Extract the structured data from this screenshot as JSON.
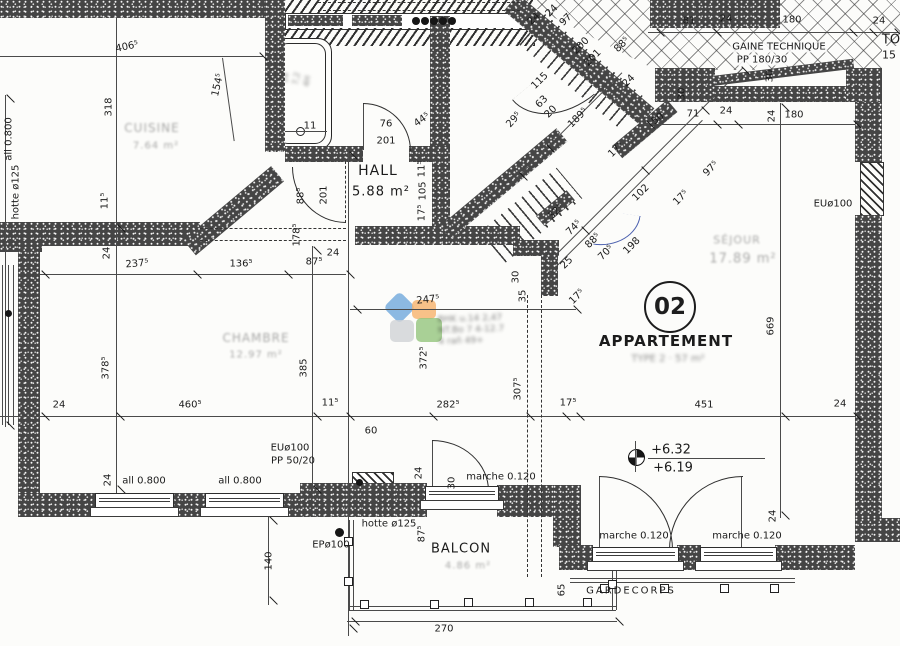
{
  "plan": {
    "apartment": {
      "number": "02",
      "title": "APPARTEMENT",
      "subtitle_faint": "TYPE 2 · 57 m²"
    },
    "rooms": [
      {
        "name": "HALL",
        "area": "5.88 m²"
      },
      {
        "name": "BALCON",
        "area_faint": "4.86 m²"
      },
      {
        "name": "SÉJOUR",
        "area_faint": "17.89 m²",
        "legibility": "faint"
      },
      {
        "name": "CHAMBRE",
        "area_faint": "12.97 m²",
        "legibility": "faint"
      },
      {
        "name": "CUISINE",
        "area_faint": "7.64 m²",
        "legibility": "faint"
      }
    ],
    "annotations": {
      "duct": "GAINE TECHNIQUE",
      "duct_detail": "PP 180/30",
      "guardrail": "GARDECORPS",
      "levels": [
        "+6.32",
        "+6.19"
      ],
      "step_label": "marche 0.120",
      "hood": "hotte ø125",
      "drain_eu": "EUø100",
      "drain_ep": "EPø100",
      "sill_height": "all 0.800",
      "pipe": "PP 50/20",
      "balcony_width": "270",
      "edge_fragments": [
        "TO",
        "15"
      ]
    },
    "colors": {
      "wall": "#454545",
      "line": "#2e2e2e",
      "pen_annotation_blue": "#4a5fae",
      "watermark_blue": "#6fa8dc",
      "watermark_orange": "#f6b26b",
      "watermark_green": "#93c47d",
      "watermark_gray": "#cfd2d6"
    },
    "texts": [
      {
        "t": "406⁵",
        "x": 127,
        "y": 47,
        "r": -12,
        "cls": "dim"
      },
      {
        "t": "318",
        "x": 109,
        "y": 107,
        "r": -90,
        "cls": "dim"
      },
      {
        "t": "154⁵",
        "x": 218,
        "y": 85,
        "r": -77,
        "cls": "dim"
      },
      {
        "t": "all 0.800",
        "x": 9,
        "y": 139,
        "r": -90,
        "cls": "lbl"
      },
      {
        "t": "hotte ø125",
        "x": 16,
        "y": 192,
        "r": -90,
        "cls": "lbl"
      },
      {
        "t": "11⁵",
        "x": 105,
        "y": 201,
        "r": -90,
        "cls": "dim"
      },
      {
        "t": "11",
        "x": 310,
        "y": 126,
        "r": 0,
        "cls": "dim"
      },
      {
        "t": "76",
        "x": 386,
        "y": 124,
        "r": 0,
        "cls": "dim"
      },
      {
        "t": "201",
        "x": 386,
        "y": 141,
        "r": 0,
        "cls": "dim"
      },
      {
        "t": "44⁵",
        "x": 422,
        "y": 120,
        "r": -35,
        "cls": "dim"
      },
      {
        "t": "29⁵",
        "x": 514,
        "y": 120,
        "r": -48,
        "cls": "dim"
      },
      {
        "t": "88⁵",
        "x": 301,
        "y": 196,
        "r": -90,
        "cls": "dim"
      },
      {
        "t": "201",
        "x": 324,
        "y": 195,
        "r": -90,
        "cls": "dim"
      },
      {
        "t": "HALL",
        "x": 378,
        "y": 171,
        "r": 0,
        "cls": "room"
      },
      {
        "t": "5.88 m²",
        "x": 381,
        "y": 192,
        "r": 0,
        "cls": "room",
        "fs": 13
      },
      {
        "t": "11⁵",
        "x": 422,
        "y": 169,
        "r": -90,
        "cls": "dim"
      },
      {
        "t": "105",
        "x": 423,
        "y": 191,
        "r": -90,
        "cls": "dim"
      },
      {
        "t": "17⁵",
        "x": 422,
        "y": 213,
        "r": -90,
        "cls": "dim"
      },
      {
        "t": "178⁵",
        "x": 297,
        "y": 235,
        "r": -90,
        "cls": "dim"
      },
      {
        "t": "24",
        "x": 107,
        "y": 253,
        "r": -90,
        "cls": "dim"
      },
      {
        "t": "24",
        "x": 333,
        "y": 253,
        "r": 0,
        "cls": "dim"
      },
      {
        "t": "237⁵",
        "x": 137,
        "y": 264,
        "r": -5,
        "cls": "dim"
      },
      {
        "t": "136⁵",
        "x": 241,
        "y": 264,
        "r": 0,
        "cls": "dim"
      },
      {
        "t": "87⁵",
        "x": 314,
        "y": 262,
        "r": 0,
        "cls": "dim"
      },
      {
        "t": "378⁵",
        "x": 106,
        "y": 368,
        "r": -90,
        "cls": "dim"
      },
      {
        "t": "385",
        "x": 304,
        "y": 368,
        "r": -90,
        "cls": "dim"
      },
      {
        "t": "24",
        "x": 59,
        "y": 405,
        "r": 0,
        "cls": "dim"
      },
      {
        "t": "460⁵",
        "x": 190,
        "y": 405,
        "r": 0,
        "cls": "dim"
      },
      {
        "t": "11⁵",
        "x": 330,
        "y": 403,
        "r": 0,
        "cls": "dim"
      },
      {
        "t": "282⁵",
        "x": 448,
        "y": 405,
        "r": 0,
        "cls": "dim"
      },
      {
        "t": "17⁵",
        "x": 568,
        "y": 403,
        "r": 0,
        "cls": "dim"
      },
      {
        "t": "451",
        "x": 704,
        "y": 405,
        "r": 0,
        "cls": "dim"
      },
      {
        "t": "24",
        "x": 840,
        "y": 404,
        "r": 0,
        "cls": "dim"
      },
      {
        "t": "247⁵",
        "x": 428,
        "y": 300,
        "r": -6,
        "cls": "dim"
      },
      {
        "t": "372⁵",
        "x": 424,
        "y": 358,
        "r": -90,
        "cls": "dim"
      },
      {
        "t": "30",
        "x": 516,
        "y": 277,
        "r": -90,
        "cls": "dim"
      },
      {
        "t": "35",
        "x": 523,
        "y": 296,
        "r": -90,
        "cls": "dim"
      },
      {
        "t": "307⁵",
        "x": 518,
        "y": 389,
        "r": -90,
        "cls": "dim"
      },
      {
        "t": "81",
        "x": 689,
        "y": 21,
        "r": 0,
        "cls": "dim"
      },
      {
        "t": "24",
        "x": 726,
        "y": 19,
        "r": 0,
        "cls": "dim"
      },
      {
        "t": "180",
        "x": 792,
        "y": 20,
        "r": 0,
        "cls": "dim"
      },
      {
        "t": "24",
        "x": 879,
        "y": 21,
        "r": 0,
        "cls": "dim"
      },
      {
        "t": "GAINE TECHNIQUE",
        "x": 779,
        "y": 47,
        "r": 0,
        "cls": "lbl bgw"
      },
      {
        "t": "PP 180/30",
        "x": 762,
        "y": 60,
        "r": 0,
        "cls": "lbl bgw"
      },
      {
        "t": "TO",
        "x": 891,
        "y": 40,
        "r": 0,
        "cls": "lbl",
        "fs": 13
      },
      {
        "t": "15",
        "x": 889,
        "y": 55,
        "r": 0,
        "cls": "lbl",
        "fs": 11
      },
      {
        "t": "30",
        "x": 682,
        "y": 94,
        "r": -90,
        "cls": "dim"
      },
      {
        "t": "30",
        "x": 770,
        "y": 76,
        "r": -90,
        "cls": "dim"
      },
      {
        "t": "50",
        "x": 658,
        "y": 119,
        "r": -38,
        "cls": "dim"
      },
      {
        "t": "71",
        "x": 693,
        "y": 114,
        "r": 0,
        "cls": "dim"
      },
      {
        "t": "24",
        "x": 726,
        "y": 111,
        "r": 0,
        "cls": "dim"
      },
      {
        "t": "24",
        "x": 772,
        "y": 116,
        "r": -90,
        "cls": "dim"
      },
      {
        "t": "180",
        "x": 794,
        "y": 115,
        "r": 0,
        "cls": "dim"
      },
      {
        "t": "115",
        "x": 540,
        "y": 81,
        "r": -45,
        "cls": "dim"
      },
      {
        "t": "63",
        "x": 542,
        "y": 102,
        "r": -45,
        "cls": "dim"
      },
      {
        "t": "20",
        "x": 551,
        "y": 112,
        "r": -45,
        "cls": "dim"
      },
      {
        "t": "189⁵",
        "x": 578,
        "y": 118,
        "r": -45,
        "cls": "dim"
      },
      {
        "t": "24",
        "x": 534,
        "y": 19,
        "r": -45,
        "cls": "dim"
      },
      {
        "t": "24",
        "x": 552,
        "y": 11,
        "r": -45,
        "cls": "dim"
      },
      {
        "t": "97",
        "x": 566,
        "y": 20,
        "r": -45,
        "cls": "dim"
      },
      {
        "t": "200",
        "x": 581,
        "y": 46,
        "r": -45,
        "cls": "dim"
      },
      {
        "t": "201",
        "x": 593,
        "y": 58,
        "r": -45,
        "cls": "dim"
      },
      {
        "t": "88⁵",
        "x": 622,
        "y": 45,
        "r": -45,
        "cls": "dim"
      },
      {
        "t": "24",
        "x": 629,
        "y": 81,
        "r": -45,
        "cls": "dim"
      },
      {
        "t": "17⁵",
        "x": 616,
        "y": 150,
        "r": -45,
        "cls": "dim"
      },
      {
        "t": "32⁵",
        "x": 556,
        "y": 212,
        "r": -45,
        "cls": "dim"
      },
      {
        "t": "74⁵",
        "x": 574,
        "y": 228,
        "r": -45,
        "cls": "dim"
      },
      {
        "t": "88⁵",
        "x": 593,
        "y": 241,
        "r": -45,
        "cls": "dim"
      },
      {
        "t": "70⁵",
        "x": 606,
        "y": 253,
        "r": -45,
        "cls": "dim"
      },
      {
        "t": "198",
        "x": 632,
        "y": 246,
        "r": -45,
        "cls": "dim"
      },
      {
        "t": "102",
        "x": 641,
        "y": 193,
        "r": -45,
        "cls": "dim"
      },
      {
        "t": "17⁵",
        "x": 681,
        "y": 198,
        "r": -45,
        "cls": "dim"
      },
      {
        "t": "97⁵",
        "x": 711,
        "y": 169,
        "r": -45,
        "cls": "dim"
      },
      {
        "t": "25",
        "x": 567,
        "y": 263,
        "r": -45,
        "cls": "dim"
      },
      {
        "t": "17⁵",
        "x": 577,
        "y": 297,
        "r": -45,
        "cls": "dim"
      },
      {
        "t": "EUø100",
        "x": 833,
        "y": 204,
        "r": 0,
        "cls": "lbl"
      },
      {
        "t": "669",
        "x": 771,
        "y": 326,
        "r": -90,
        "cls": "dim"
      },
      {
        "t": "SÉJOUR",
        "x": 737,
        "y": 240,
        "r": 0,
        "cls": "faint",
        "fs": 11
      },
      {
        "t": "17.89 m²",
        "x": 743,
        "y": 259,
        "r": 0,
        "cls": "faint",
        "fs": 13
      },
      {
        "t": "TYPE 2 · 57 m²",
        "x": 668,
        "y": 359,
        "r": 0,
        "cls": "faint2",
        "fs": 10
      },
      {
        "t": "CHAMBRE",
        "x": 256,
        "y": 338,
        "r": 0,
        "cls": "faint",
        "fs": 12
      },
      {
        "t": "12.97 m²",
        "x": 256,
        "y": 355,
        "r": 0,
        "cls": "faint",
        "fs": 10
      },
      {
        "t": "CUISINE",
        "x": 152,
        "y": 128,
        "r": 0,
        "cls": "faint",
        "fs": 12
      },
      {
        "t": "7.64 m²",
        "x": 156,
        "y": 146,
        "r": 0,
        "cls": "faint",
        "fs": 10
      },
      {
        "t": "EUø100",
        "x": 290,
        "y": 448,
        "r": 0,
        "cls": "lbl"
      },
      {
        "t": "PP 50/20",
        "x": 293,
        "y": 461,
        "r": 0,
        "cls": "lbl"
      },
      {
        "t": "60",
        "x": 371,
        "y": 431,
        "r": 0,
        "cls": "dim"
      },
      {
        "t": "24",
        "x": 419,
        "y": 473,
        "r": -90,
        "cls": "dim"
      },
      {
        "t": "30",
        "x": 452,
        "y": 483,
        "r": -90,
        "cls": "dim"
      },
      {
        "t": "marche 0.120",
        "x": 501,
        "y": 477,
        "r": 0,
        "cls": "lbl"
      },
      {
        "t": "hotte ø125",
        "x": 389,
        "y": 524,
        "r": 0,
        "cls": "lbl"
      },
      {
        "t": "87⁵",
        "x": 422,
        "y": 534,
        "r": -90,
        "cls": "dim"
      },
      {
        "t": "BALCON",
        "x": 461,
        "y": 549,
        "r": 0,
        "cls": "room",
        "fs": 13
      },
      {
        "t": "4.86 m²",
        "x": 468,
        "y": 566,
        "r": 0,
        "cls": "faint",
        "fs": 10
      },
      {
        "t": "140",
        "x": 269,
        "y": 561,
        "r": -90,
        "cls": "dim"
      },
      {
        "t": "EPø100",
        "x": 331,
        "y": 545,
        "r": 0,
        "cls": "lbl"
      },
      {
        "t": "all 0.800",
        "x": 144,
        "y": 481,
        "r": 0,
        "cls": "lbl"
      },
      {
        "t": "all 0.800",
        "x": 240,
        "y": 481,
        "r": 0,
        "cls": "lbl"
      },
      {
        "t": "24",
        "x": 108,
        "y": 480,
        "r": -90,
        "cls": "dim"
      },
      {
        "t": "270",
        "x": 444,
        "y": 629,
        "r": 0,
        "cls": "dim"
      },
      {
        "t": "65",
        "x": 562,
        "y": 590,
        "r": -90,
        "cls": "dim"
      },
      {
        "t": "GARDECORPS",
        "x": 631,
        "y": 591,
        "r": 0,
        "cls": "lbl",
        "ls": 2
      },
      {
        "t": "marche 0.120",
        "x": 634,
        "y": 536,
        "r": 0,
        "cls": "lbl"
      },
      {
        "t": "marche 0.120",
        "x": 747,
        "y": 536,
        "r": 0,
        "cls": "lbl"
      },
      {
        "t": "+6.32",
        "x": 671,
        "y": 450,
        "r": 0,
        "cls": "level"
      },
      {
        "t": "+6.19",
        "x": 673,
        "y": 468,
        "r": 0,
        "cls": "level"
      },
      {
        "t": "24",
        "x": 773,
        "y": 516,
        "r": -90,
        "cls": "dim"
      }
    ],
    "smudges": {
      "center_stamp": [
        "BHK u.14 2,47",
        "NT.Bo 7 4-12.7",
        "4 rañ 49+"
      ],
      "bathtub_note": [
        "14",
        "7,2",
        "4H"
      ]
    }
  }
}
